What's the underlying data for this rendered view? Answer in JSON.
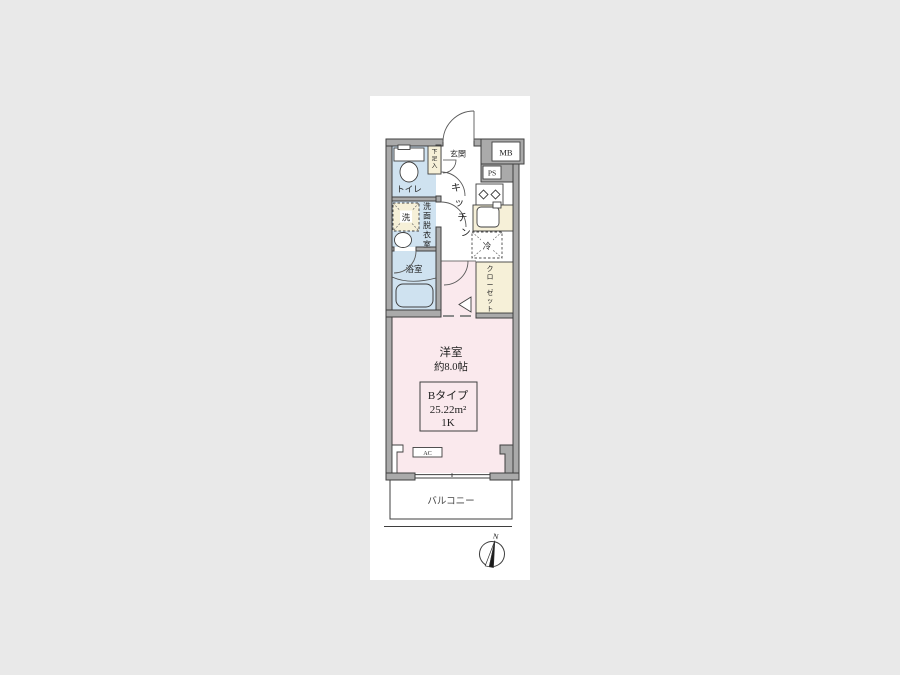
{
  "labels": {
    "entrance": "玄関",
    "shoe_cabinet": "下足入",
    "meter_box": "MB",
    "pipe_shaft": "PS",
    "toilet": "トイレ",
    "kitchen": "キッチン",
    "washing_machine": "洗",
    "washroom": "洗面脱衣室",
    "bathroom": "浴室",
    "refrigerator": "冷",
    "closet": "クローゼット",
    "main_room_name": "洋室",
    "main_room_size": "約8.0帖",
    "air_conditioner": "AC",
    "balcony": "バルコニー",
    "compass_north": "N"
  },
  "unit_info": {
    "type": "Bタイプ",
    "area": "25.22m²",
    "layout": "1K"
  },
  "colors": {
    "background": "#e9e9e9",
    "paper": "#ffffff",
    "wall": "#aaaaaa",
    "wet_area": "#cfe2f0",
    "room": "#fae9ed",
    "storage": "#f6f0d8",
    "line": "#3f3f3f"
  }
}
